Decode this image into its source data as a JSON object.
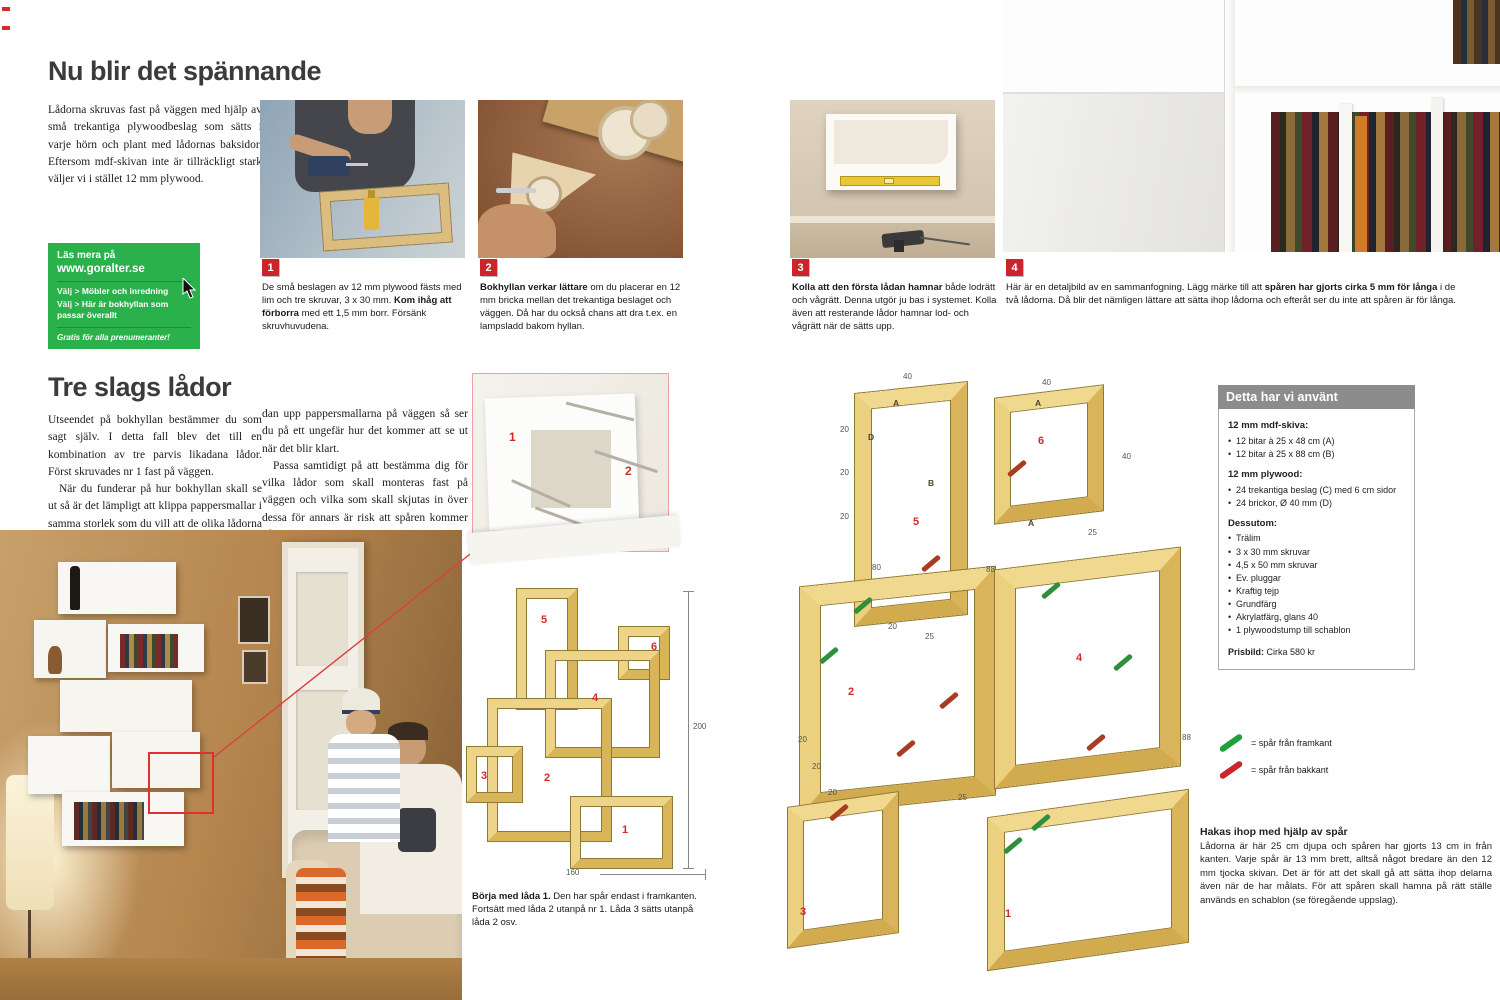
{
  "colors": {
    "accent_red": "#c9252b",
    "promo_green": "#2ab14b",
    "legend_green": "#1fa03c",
    "legend_red": "#c9252b",
    "wood": "#e8c977",
    "materials_header_gray": "#8c8c8c"
  },
  "article1": {
    "title": "Nu blir det spännande",
    "intro": "Lådorna skruvas fast på väggen med hjälp av små trekantiga plywoodbeslag som sätts i varje hörn och plant med lådornas baksidor. Eftersom mdf-skivan inte är tillräckligt stark väljer vi i stället 12 mm plywood."
  },
  "promo": {
    "line1": "Läs mera på",
    "line2": "www.goralter.se",
    "choice_prefix": "Välj >",
    "choice1": "Möbler och inredning",
    "choice2": "Här är bokhyllan som passar överallt",
    "footer": "Gratis för alla prenumeranter!"
  },
  "steps": [
    {
      "number": "1",
      "pre": "De små beslagen av 12 mm plywood fästs med lim och tre skruvar, 3 x 30 mm. ",
      "bold": "Kom ihåg att förborra",
      "post": " med ett 1,5 mm borr. Försänk skruvhuvudena."
    },
    {
      "number": "2",
      "pre": "",
      "bold": "Bokhyllan verkar lättare",
      "post": " om du placerar en 12 mm bricka mellan det trekantiga beslaget och väggen. Då har du också chans att dra t.ex. en lampsladd bakom hyllan."
    },
    {
      "number": "3",
      "pre": "",
      "bold": "Kolla att den första lådan hamnar",
      "post": " både lodrätt och vågrätt. Denna utgör ju bas i systemet. Kolla även att resterande lådor hamnar lod- och vågrätt när de sätts upp."
    },
    {
      "number": "4",
      "pre": "Här är en detaljbild av en sammanfogning. Lägg märke till att ",
      "bold": "spåren har gjorts cirka 5 mm för långa",
      "post": " i de två lådorna. Då blir det nämligen lättare att sätta ihop lådorna och efteråt ser du inte att spåren är för långa."
    }
  ],
  "article2": {
    "title": "Tre slags lådor",
    "col1_p1": "Utseendet på bokhyllan bestämmer du som sagt själv. I detta fall blev det till en kombination av tre parvis likadana lådor. Först skruvades nr 1 fast på väggen.",
    "col1_p2": "När du funderar på hur bokhyllan skall se ut så är det lämpligt att klippa pappersmallar i samma storlek som du vill att de olika lådorna skall ha. Sätt se-",
    "col2_p1": "dan upp pappersmallarna på väggen så ser du på ett ungefär hur det kommer att se ut när det blir klart.",
    "col2_p2": "Passa samtidigt på att bestämma dig för vilka lådor som skall monteras fast på väggen och vilka som skall skjutas in över dessa för annars är risk att spåren kommer på fel ställe."
  },
  "inset": {
    "n1": "1",
    "n2": "2"
  },
  "layout_diagram": {
    "height_label": "200",
    "width_label": "160",
    "boxes": [
      "1",
      "2",
      "3",
      "4",
      "5",
      "6"
    ]
  },
  "start_caption": {
    "bold": "Börja med låda 1.",
    "rest": " Den har spår endast i framkanten. Fortsätt med låda 2 utanpå nr 1. Låda 3 sätts utanpå låda 2 osv."
  },
  "exploded": {
    "numbers": [
      "1",
      "2",
      "3",
      "4",
      "5",
      "6"
    ],
    "letters": [
      "A",
      "B",
      "A",
      "A",
      "D"
    ],
    "dims": [
      "40",
      "40",
      "40",
      "25",
      "20",
      "20",
      "20",
      "20",
      "25",
      "88",
      "80",
      "88",
      "25",
      "20",
      "20",
      "20"
    ]
  },
  "materials": {
    "header": "Detta har vi använt",
    "group1_title": "12 mm mdf-skiva:",
    "group1": [
      "12 bitar à 25 x 48 cm (A)",
      "12 bitar à 25 x 88 cm (B)"
    ],
    "group2_title": "12 mm plywood:",
    "group2": [
      "24 trekantiga beslag (C) med 6 cm sidor",
      "24 brickor, Ø 40 mm (D)"
    ],
    "group3_title": "Dessutom:",
    "group3": [
      "Trälim",
      "3 x 30 mm skruvar",
      "4,5 x 50 mm skruvar",
      "Ev. pluggar",
      "Kraftig tejp",
      "Grundfärg",
      "Akrylatfärg, glans 40",
      "1 plywoodstump till schablon"
    ],
    "price_label": "Prisbild:",
    "price_value": "Cirka 580 kr"
  },
  "legend": {
    "green": "= spår från framkant",
    "red": "= spår från bakkant"
  },
  "assembly": {
    "title": "Hakas ihop med hjälp av spår",
    "body": "Lådorna är här 25 cm djupa och spåren har gjorts 13 cm in från kanten. Varje spår är 13 mm brett, alltså något bredare än den 12 mm tjocka skivan. Det är för att det skall gå att sätta ihop delarna även när de har målats. För att spåren skall hamna på rätt ställe används en schablon (se föregående uppslag)."
  }
}
